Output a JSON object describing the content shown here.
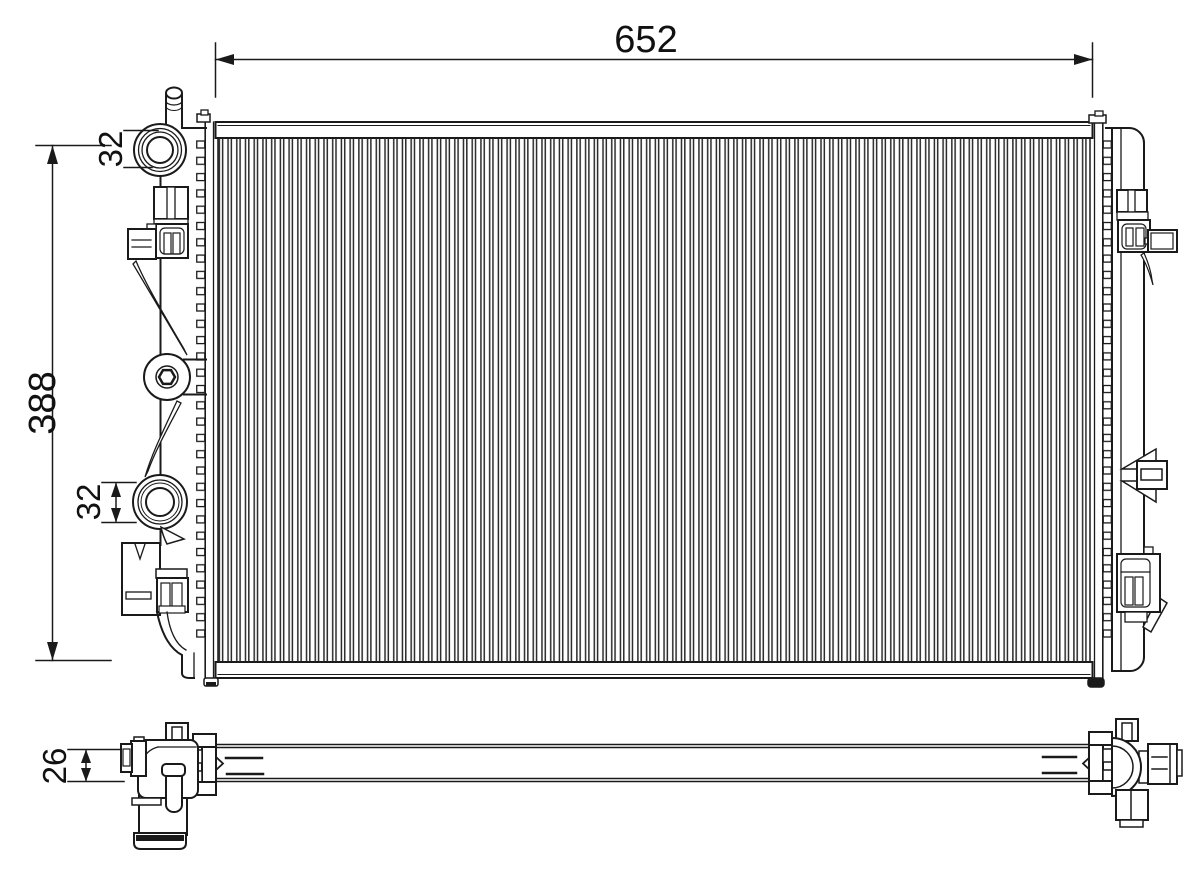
{
  "drawing_title": "radiator-technical-drawing",
  "dims": {
    "width": "652",
    "height": "388",
    "top_port": "32",
    "bottom_port": "32",
    "depth": "26"
  },
  "colors": {
    "line": "#1a1a1a",
    "background": "#ffffff",
    "fins": "#2b2b2b"
  }
}
